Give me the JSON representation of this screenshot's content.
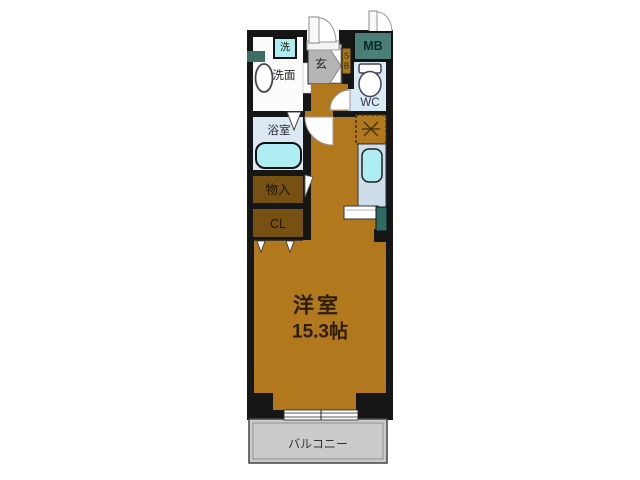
{
  "plan": {
    "main_room": {
      "name": "洋室",
      "size": "15.3帖"
    },
    "labels": {
      "bathroom": "浴室",
      "washstand": "洗面",
      "laundry": "洗",
      "entrance": "玄",
      "shoe_box_top": "S",
      "shoe_box_bottom": "B",
      "meter_box": "MB",
      "toilet": "WC",
      "storage": "物入",
      "closet": "CL",
      "balcony": "バルコニー"
    }
  },
  "colors": {
    "wall": "#161616",
    "room_floor": "#b1781e",
    "closet_brown": "#765112",
    "entrance_gray": "#b5b5b5",
    "shoe_box_gold": "#a87818",
    "meter_box_teal": "#4a7f78",
    "wc_floor": "#d9e9f6",
    "bath_floor": "#dce9f2",
    "fixture_cyan": "#aeeef2",
    "counter_blue": "#cddde9",
    "stove_teal": "#2e6b62",
    "window_teal": "#3d6e66",
    "balcony_gray": "#cbcbcb",
    "background": "#ffffff"
  },
  "icons": {
    "refrigerator_mark": "crossed-lines-dashed-box",
    "toilet_icon": "tank-and-bowl",
    "bathtub_icon": "rounded-tub",
    "door_arcs": "quarter-circle-swing"
  }
}
